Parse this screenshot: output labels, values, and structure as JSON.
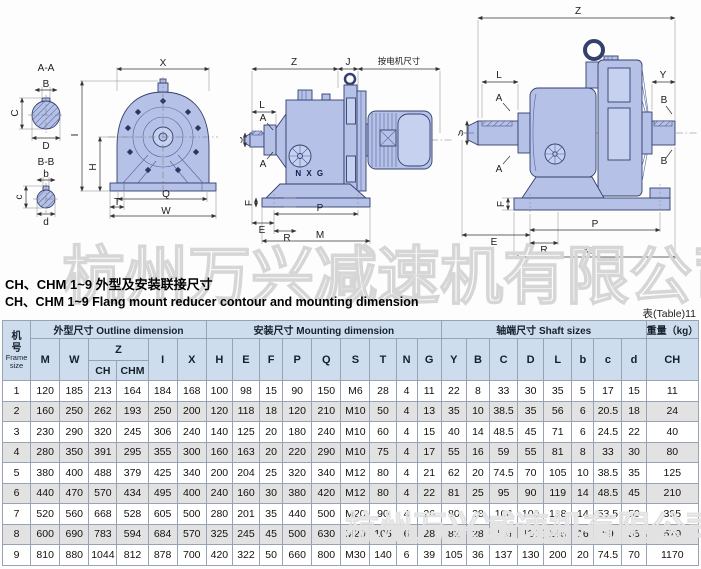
{
  "watermark": "杭州万兴减速机有限公司",
  "header": {
    "title_zh": "CH、CHM 1~9 外型及安装联接尺寸",
    "title_en": "CH、CHM 1~9 Flang mount reducer contour and mounting dimension",
    "table_ref": "表(Table)11"
  },
  "drawings": {
    "d1": {
      "secA": "A-A",
      "secB": "B-B",
      "B": "B",
      "C": "C",
      "D": "D",
      "b": "b",
      "c": "c",
      "d": "d",
      "X": "X",
      "I": "I",
      "H": "H",
      "Q": "Q",
      "T": "T",
      "W": "W"
    },
    "d2": {
      "Z": "Z",
      "J": "J",
      "note": "按电机尺寸",
      "L": "L",
      "A1": "A",
      "A2": "A",
      "S": "S",
      "brand": "N X G",
      "F": "F",
      "E": "E",
      "R": "R",
      "P": "P",
      "M": "M"
    },
    "d3": {
      "Z": "Z",
      "Y": "Y",
      "L": "L",
      "A1": "A",
      "A2": "A",
      "S": "S",
      "B1": "B",
      "B2": "B",
      "brand": "N X G",
      "F": "F",
      "E": "E",
      "R": "R",
      "P": "P",
      "M": "M"
    }
  },
  "table": {
    "frame_zh": "机号",
    "frame_en": "Frame size",
    "group_outline": "外型尺寸 Outline dimension",
    "group_mounting": "安装尺寸 Mounting dimension",
    "group_shaft": "轴端尺寸 Shaft sizes",
    "group_weight": "重量（kg）",
    "cols": [
      "M",
      "W",
      "Z",
      "CH",
      "CHM",
      "I",
      "X",
      "H",
      "E",
      "F",
      "P",
      "Q",
      "S",
      "T",
      "N",
      "G",
      "Y",
      "B",
      "C",
      "D",
      "L",
      "b",
      "c",
      "d",
      "CH"
    ],
    "rows": [
      [
        "1",
        "120",
        "185",
        "213",
        "164",
        "184",
        "168",
        "100",
        "98",
        "15",
        "90",
        "150",
        "M6",
        "28",
        "4",
        "11",
        "22",
        "8",
        "33",
        "30",
        "35",
        "5",
        "17",
        "15",
        "11"
      ],
      [
        "2",
        "160",
        "250",
        "262",
        "193",
        "250",
        "200",
        "120",
        "118",
        "18",
        "120",
        "210",
        "M10",
        "50",
        "4",
        "13",
        "35",
        "10",
        "38.5",
        "35",
        "56",
        "6",
        "20.5",
        "18",
        "24"
      ],
      [
        "3",
        "230",
        "290",
        "320",
        "245",
        "306",
        "240",
        "140",
        "125",
        "20",
        "180",
        "240",
        "M10",
        "60",
        "4",
        "15",
        "40",
        "14",
        "48.5",
        "45",
        "71",
        "6",
        "24.5",
        "22",
        "40"
      ],
      [
        "4",
        "280",
        "350",
        "391",
        "295",
        "355",
        "300",
        "160",
        "163",
        "20",
        "220",
        "290",
        "M10",
        "75",
        "4",
        "17",
        "55",
        "16",
        "59",
        "55",
        "81",
        "8",
        "33",
        "30",
        "80"
      ],
      [
        "5",
        "380",
        "400",
        "488",
        "379",
        "425",
        "340",
        "200",
        "204",
        "25",
        "320",
        "340",
        "M12",
        "80",
        "4",
        "21",
        "62",
        "20",
        "74.5",
        "70",
        "105",
        "10",
        "38.5",
        "35",
        "125"
      ],
      [
        "6",
        "440",
        "470",
        "570",
        "434",
        "495",
        "400",
        "240",
        "160",
        "30",
        "380",
        "420",
        "M12",
        "80",
        "4",
        "22",
        "81",
        "25",
        "95",
        "90",
        "119",
        "14",
        "48.5",
        "45",
        "210"
      ],
      [
        "7",
        "520",
        "560",
        "668",
        "528",
        "605",
        "500",
        "280",
        "201",
        "35",
        "440",
        "500",
        "M20",
        "90",
        "4",
        "26",
        "80",
        "28",
        "106",
        "100",
        "138",
        "14",
        "53.5",
        "50",
        "395"
      ],
      [
        "8",
        "600",
        "690",
        "783",
        "594",
        "684",
        "570",
        "325",
        "245",
        "45",
        "500",
        "630",
        "M20",
        "105",
        "6",
        "28",
        "82",
        "28",
        "116",
        "110",
        "165",
        "16",
        "59",
        "55",
        "570"
      ],
      [
        "9",
        "810",
        "880",
        "1044",
        "812",
        "878",
        "700",
        "420",
        "322",
        "50",
        "660",
        "800",
        "M30",
        "140",
        "6",
        "39",
        "105",
        "36",
        "137",
        "130",
        "200",
        "20",
        "74.5",
        "70",
        "1170"
      ]
    ]
  }
}
